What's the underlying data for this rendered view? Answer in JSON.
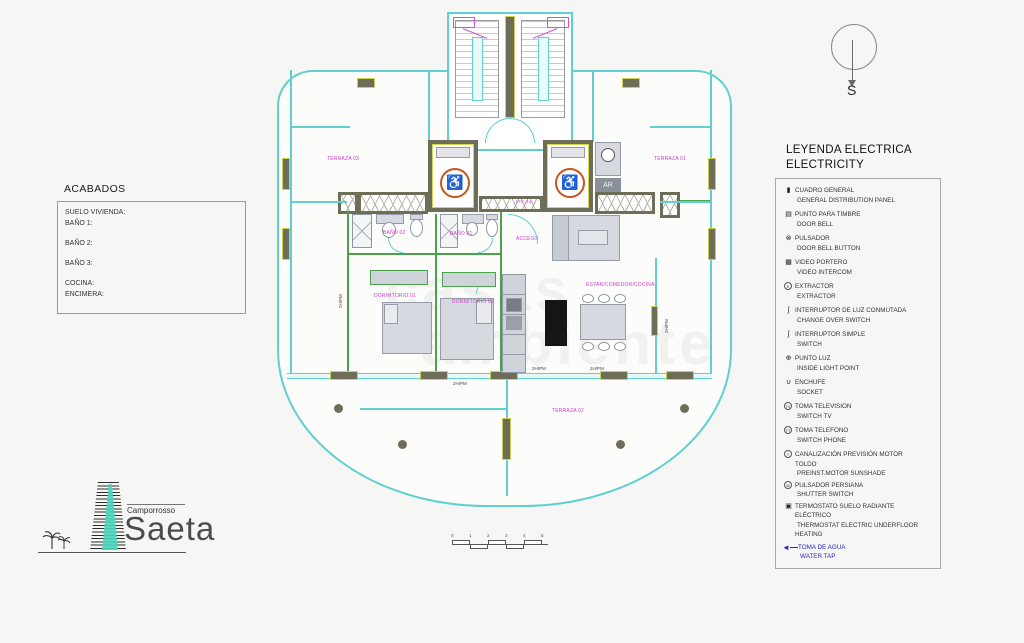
{
  "compass": {
    "label": "S"
  },
  "acabados": {
    "title": "ACABADOS",
    "lines": [
      "SUELO VIVIENDA:",
      "BAÑO 1:",
      "BAÑO 2:",
      "BAÑO 3:",
      "COCINA:",
      "ENCIMERA:"
    ]
  },
  "legend": {
    "title_es": "LEYENDA ELECTRICA",
    "title_en": "ELECTRICITY",
    "items": [
      {
        "glyph": "▮",
        "es": "CUADRO GENERAL",
        "en": "GENERAL DISTRIBUTION PANEL"
      },
      {
        "glyph": "▤",
        "es": "PUNTO PARA TIMBRE",
        "en": "DOOR BELL"
      },
      {
        "glyph": "⊗",
        "es": "PULSADOR",
        "en": "DOOR BELL BUTTON"
      },
      {
        "glyph": "▦",
        "es": "VIDEO PORTERO",
        "en": "VIDEO INTERCOM"
      },
      {
        "glyph": "E",
        "es": "EXTRACTOR",
        "en": "EXTRACTOR"
      },
      {
        "glyph": "ʃ",
        "es": "INTERRUPTOR DE LUZ CONMUTADA",
        "en": "CHANGE OVER SWITCH"
      },
      {
        "glyph": "ʃ",
        "es": "INTERRUPTOR SIMPLE",
        "en": "SWITCH"
      },
      {
        "glyph": "⊕",
        "es": "PUNTO LUZ",
        "en": "INSIDE LIGHT POINT"
      },
      {
        "glyph": "∪",
        "es": "ENCHUFE",
        "en": "SOCKET"
      },
      {
        "glyph": "TV",
        "es": "TOMA TELEVISION",
        "en": "SWITCH TV"
      },
      {
        "glyph": "TT",
        "es": "TOMA TELEFONO",
        "en": "SWITCH PHONE"
      },
      {
        "glyph": "T",
        "es": "CANALIZACIÓN PREVISIÓN MOTOR TOLDO",
        "en": "PREINST.MOTOR SUNSHADE"
      },
      {
        "glyph": "M",
        "es": "PULSADOR PERSIANA",
        "en": "SHUTTER SWITCH"
      },
      {
        "glyph": "▣",
        "es": "TERMOSTATO SUELO RADIANTE ELÉCTRICO",
        "en": "THERMOSTAT ELECTRIC UNDERFLOOR HEATING"
      },
      {
        "glyph": "◄",
        "es": "TOMA DE AGUA",
        "en": "WATER TAP"
      }
    ]
  },
  "plan": {
    "rooms": {
      "terraza03": "TERRAZA 03",
      "terraza01": "TERRAZA 01",
      "terraza02": "TERRAZA 02",
      "bano02": "BAÑO 02",
      "bano01": "BAÑO 01",
      "dorm01": "DORMITORIO 01",
      "dorm02": "DORMITORIO 02",
      "estar": "ESTAR/COMEDOR/COCINA"
    },
    "viv_label": "VIV. 14",
    "acceso_label": "ACCESO",
    "dim_label": "2H/PM",
    "appliance_label": "AR",
    "wheelchair_glyph": "♿",
    "colors": {
      "wall_cyan": "#5fd0d0",
      "partition_green": "#4aa34a",
      "structure_olive": "#6e6e58",
      "accent_yellow": "#d6d64e",
      "room_label": "#cb3fcb",
      "stair_pink": "#efb0ea",
      "lift_orange": "#c6551e",
      "water_blue": "#2626c9"
    }
  },
  "watermark": {
    "line1": "casas",
    "line2": "ambiente"
  },
  "logo": {
    "top": "Camporrosso",
    "name": "Saeta"
  },
  "scalebar": {
    "ticks": [
      "0",
      "1",
      "2",
      "3",
      "4",
      "5"
    ]
  }
}
